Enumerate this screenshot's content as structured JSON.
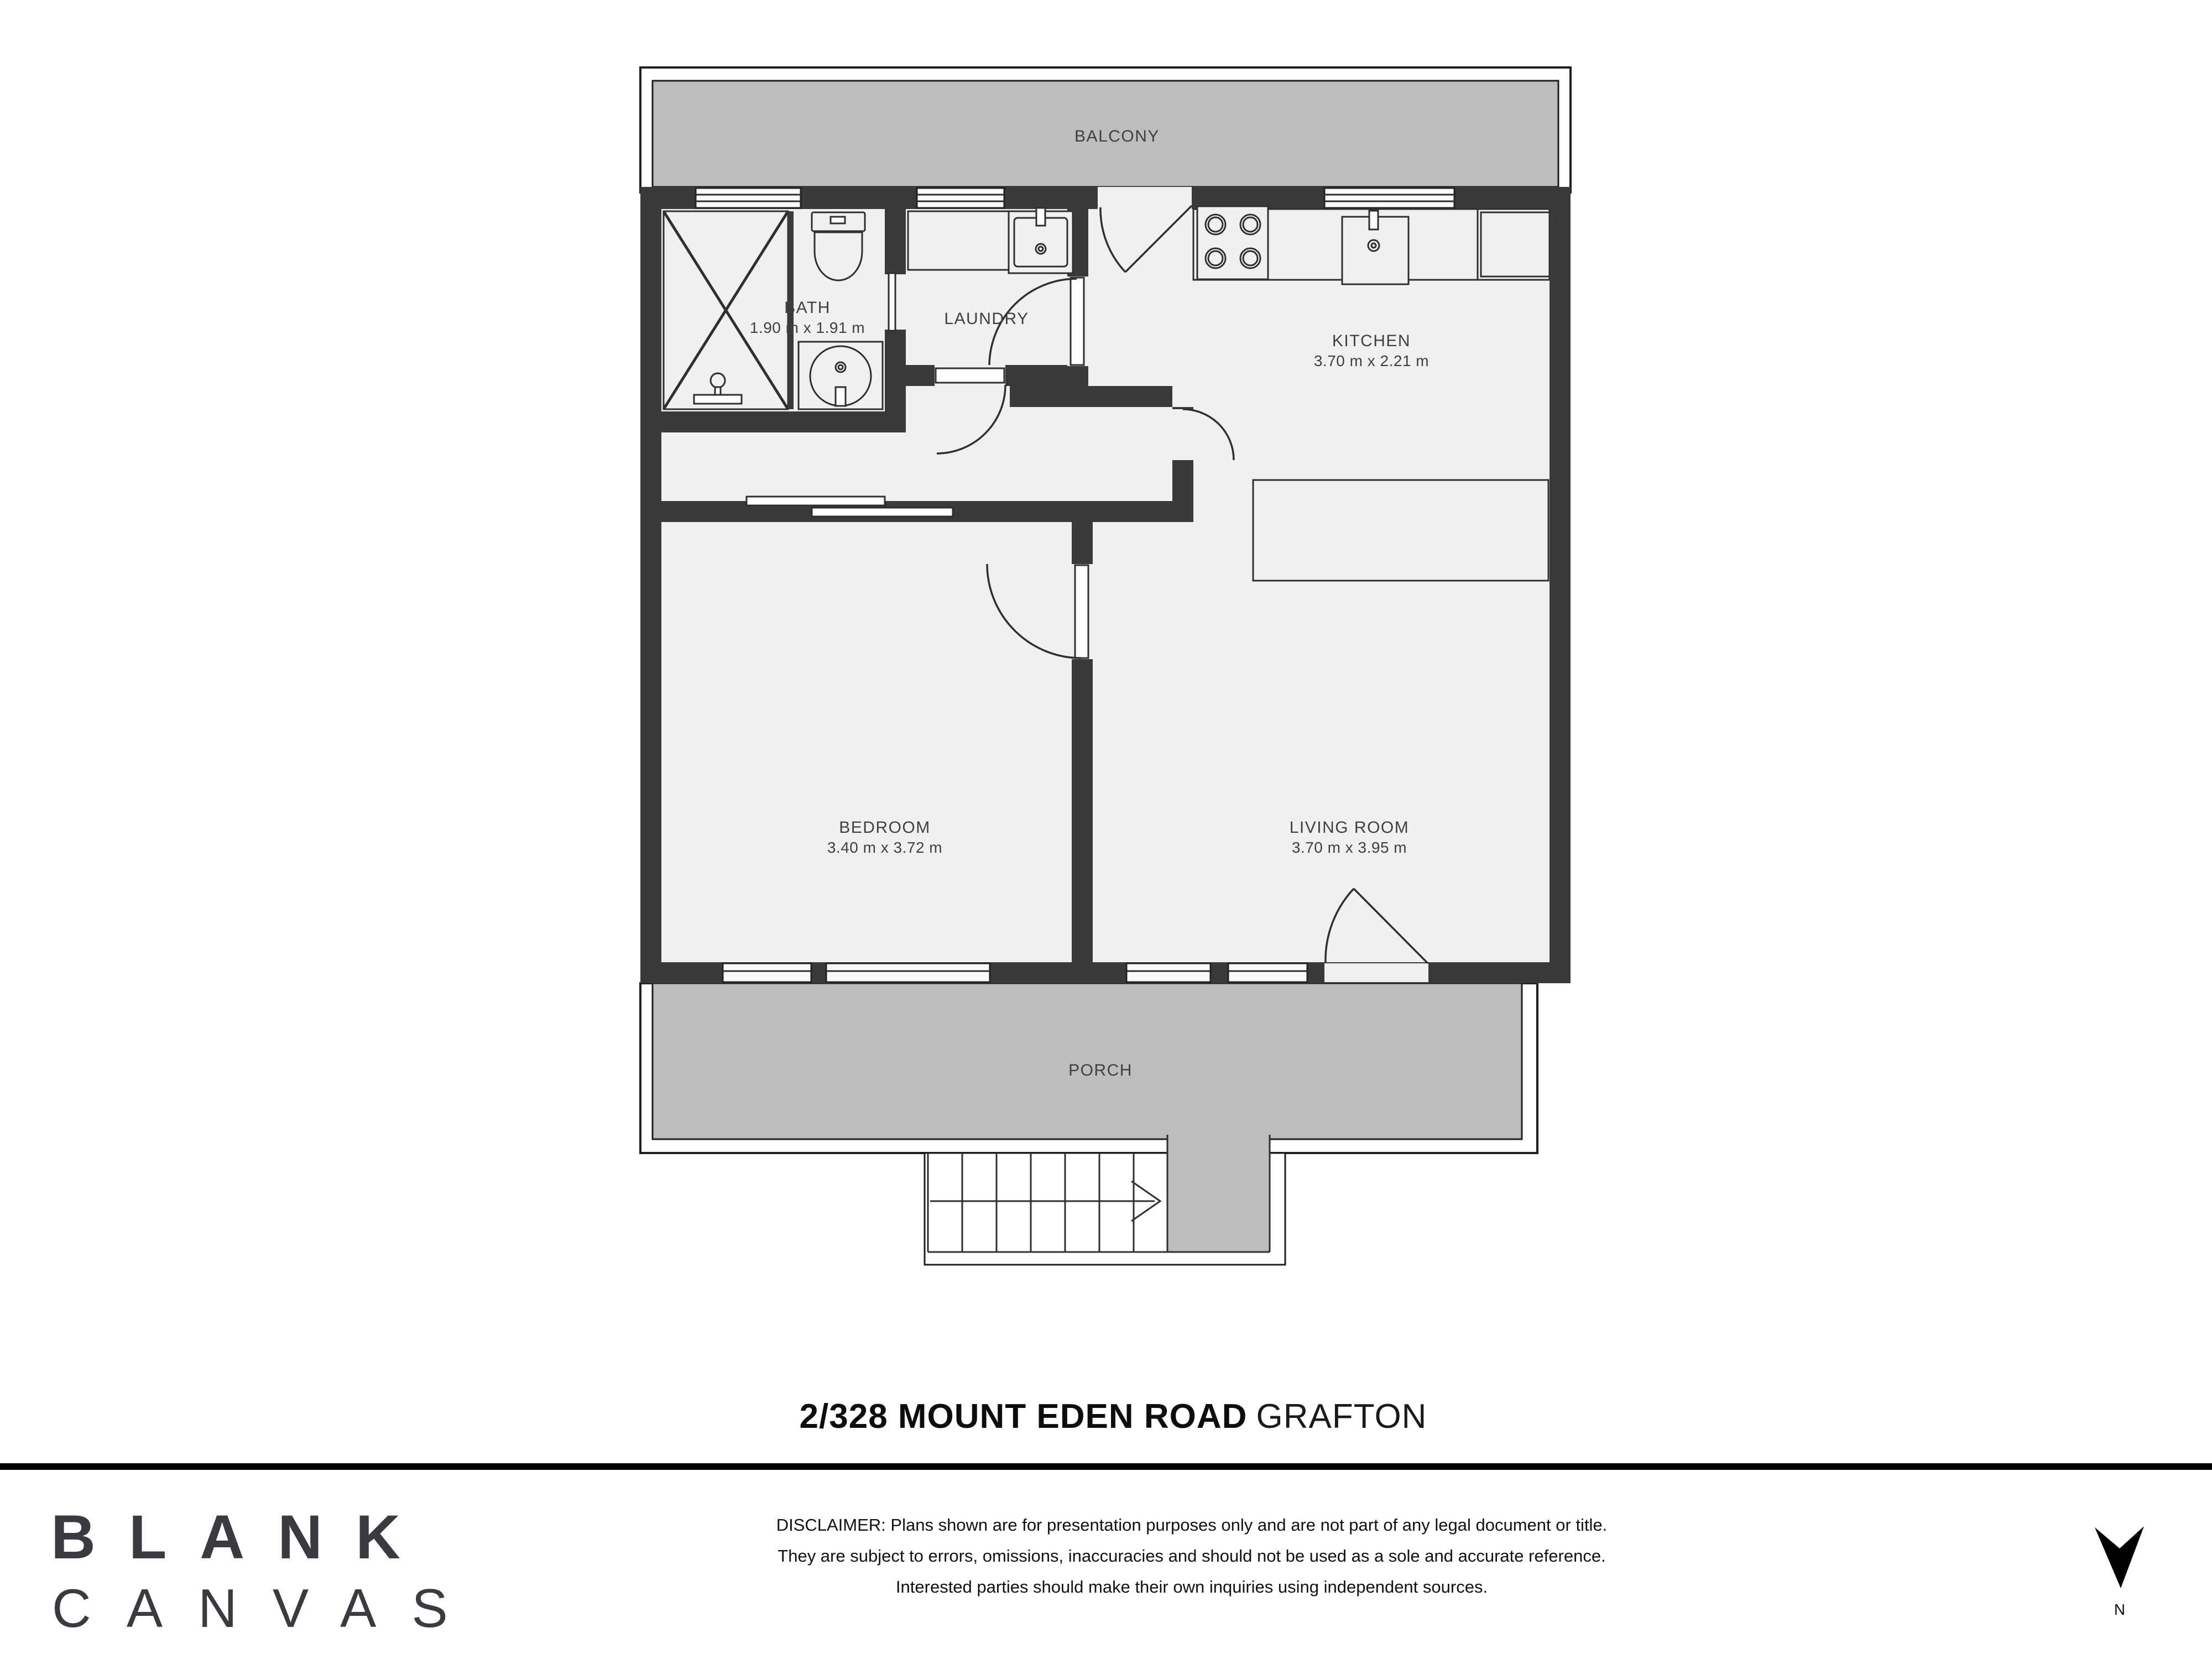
{
  "colors": {
    "wall": "#3a3a3a",
    "room_floor": "#f0f0f0",
    "outdoor_floor": "#bdbdbd",
    "outline": "#1f1f1f",
    "label_text": "#3f3f3f",
    "title_text": "#0d0d0d",
    "logo_text": "#3a3a40"
  },
  "plan": {
    "rooms": [
      {
        "id": "balcony",
        "label": "BALCONY",
        "dims": ""
      },
      {
        "id": "bath",
        "label": "BATH",
        "dims": "1.90 m x 1.91 m"
      },
      {
        "id": "laundry",
        "label": "LAUNDRY",
        "dims": ""
      },
      {
        "id": "kitchen",
        "label": "KITCHEN",
        "dims": "3.70 m x 2.21 m"
      },
      {
        "id": "bedroom",
        "label": "BEDROOM",
        "dims": "3.40 m x 3.72 m"
      },
      {
        "id": "living_room",
        "label": "LIVING ROOM",
        "dims": "3.70 m x 3.95 m"
      },
      {
        "id": "porch",
        "label": "PORCH",
        "dims": ""
      }
    ]
  },
  "title": {
    "address": "2/328 MOUNT EDEN ROAD",
    "suburb": "GRAFTON"
  },
  "footer": {
    "logo": [
      "BLANK",
      "CANVAS"
    ],
    "disclaimer": [
      "DISCLAIMER: Plans shown are for presentation purposes only and are not part of any legal document or title.",
      "They are subject to errors, omissions, inaccuracies and should not be used as a sole and accurate reference.",
      "Interested parties should make their own inquiries using independent sources."
    ],
    "compass_label": "N"
  }
}
